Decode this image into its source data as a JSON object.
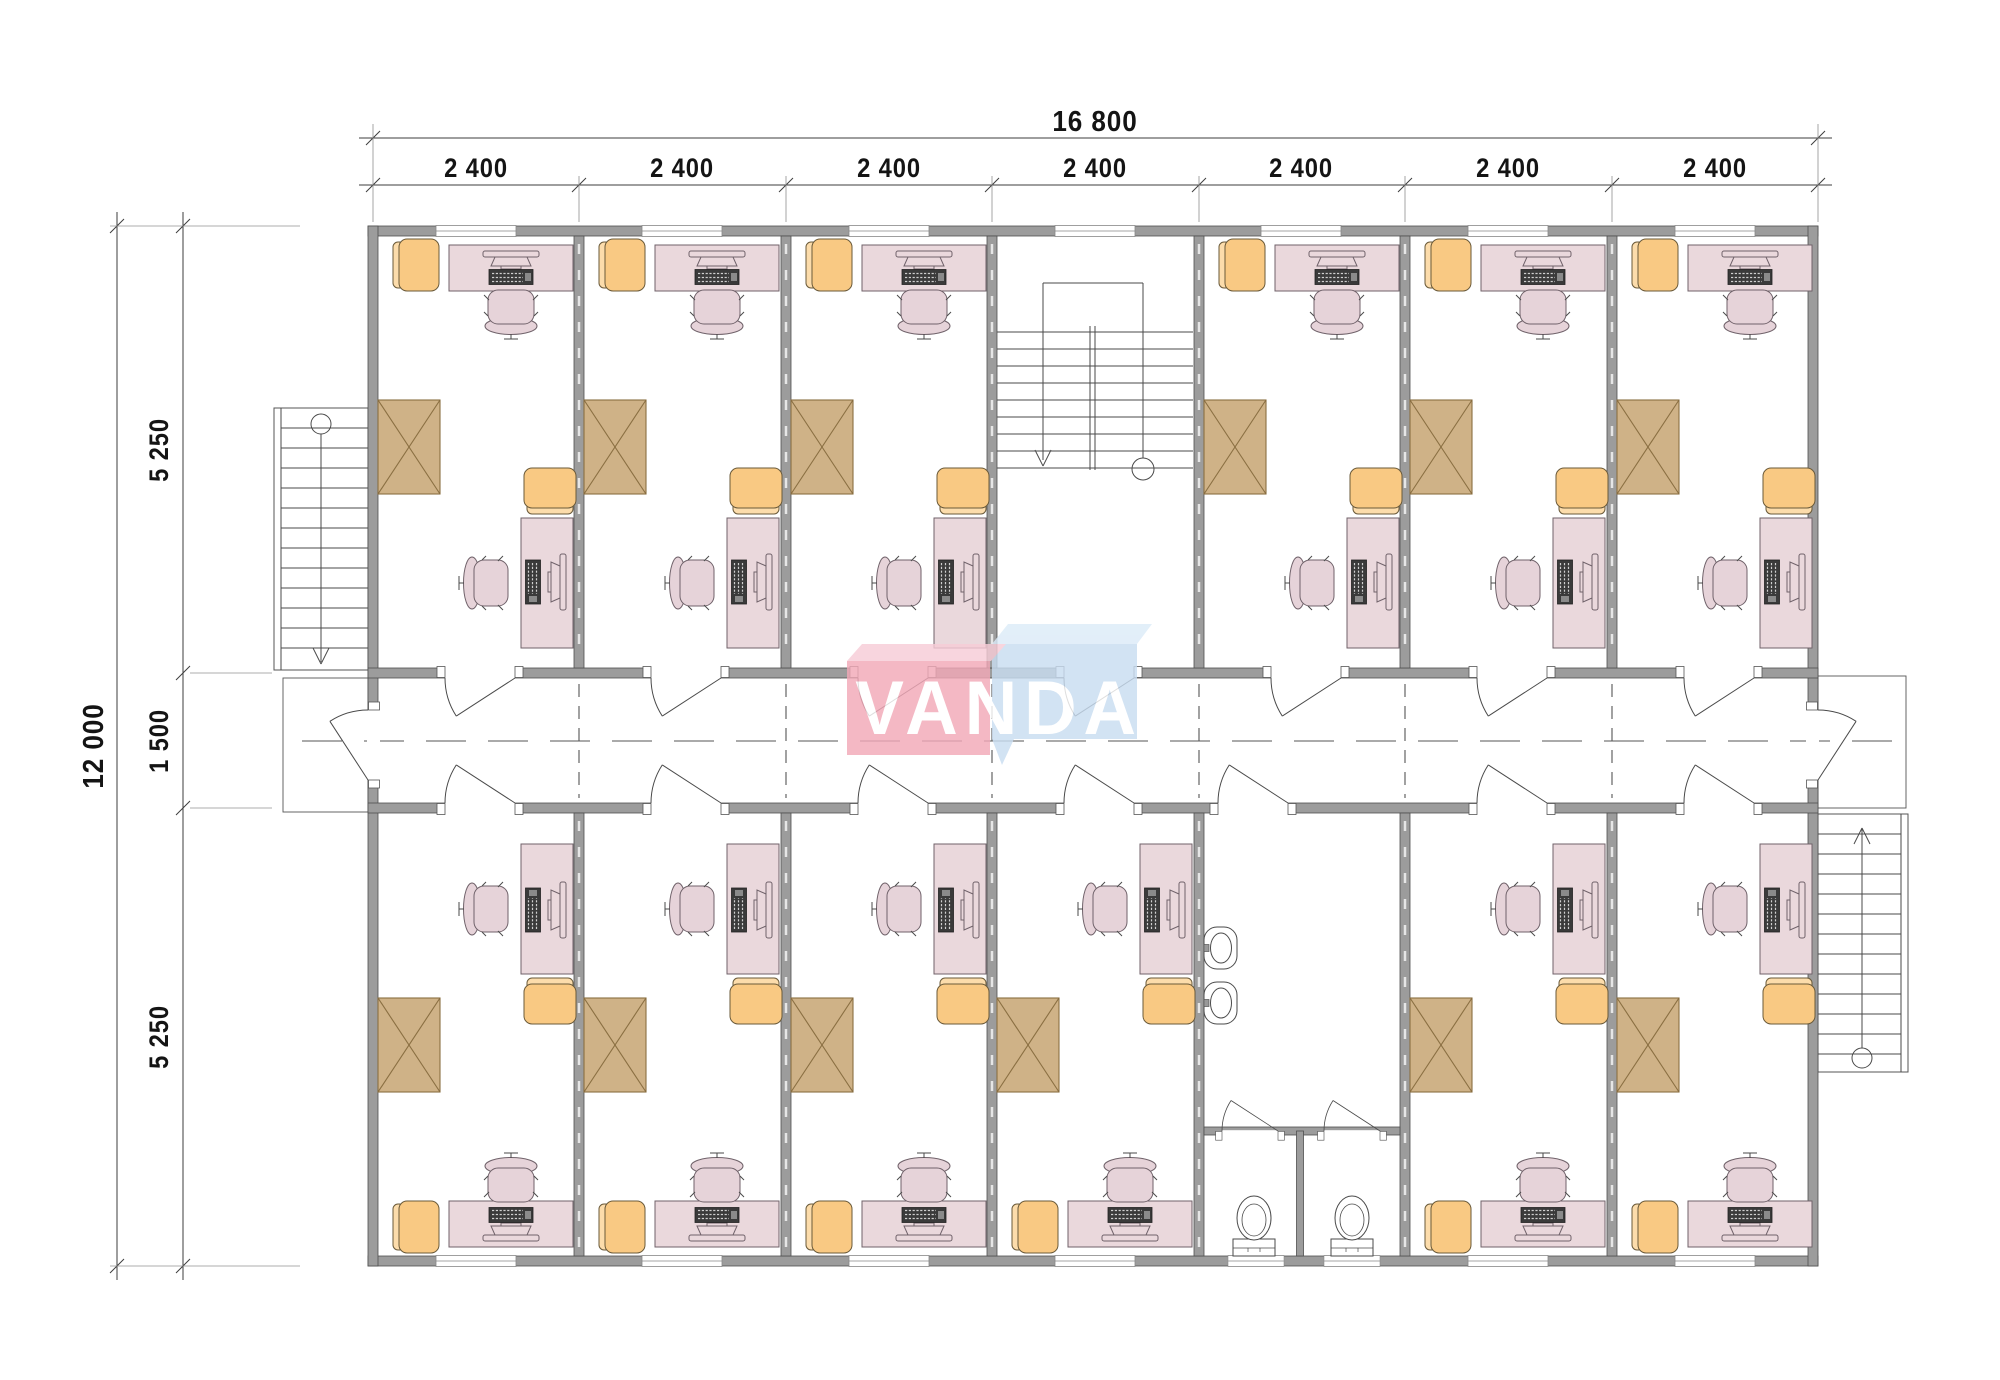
{
  "watermark": {
    "text": "VANDA",
    "pink_color": "#f2a9b8",
    "blue_color": "#c9ddf1"
  },
  "dimensions": {
    "top_total": "16 800",
    "top_segments": [
      "2 400",
      "2 400",
      "2 400",
      "2 400",
      "2 400",
      "2 400",
      "2 400"
    ],
    "left_total": "12 000",
    "left_segments": [
      "5 250",
      "1 500",
      "5 250"
    ]
  },
  "colors": {
    "wall": "#9c9c9c",
    "desk": "#ead8dc",
    "office_chair": "#e6d3d9",
    "armchair": "#f9c983",
    "cabinet": "#cfb287"
  }
}
